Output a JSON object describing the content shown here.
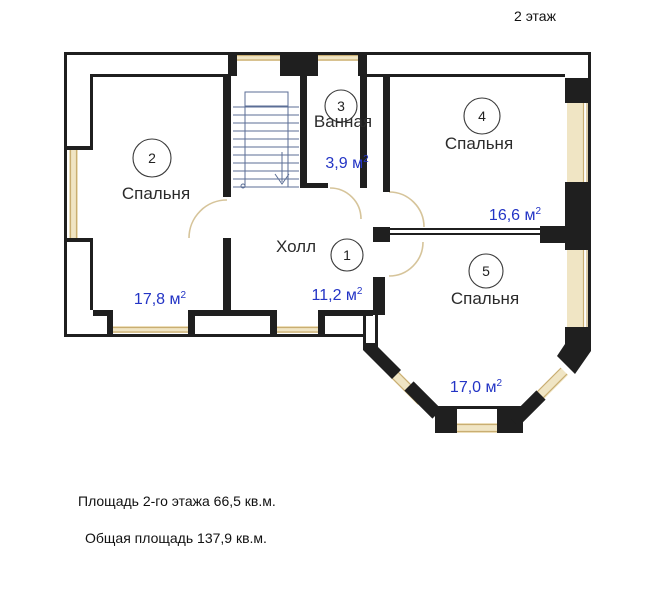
{
  "title": "2 этаж",
  "rooms": [
    {
      "number": "1",
      "name": "Холл",
      "area": "11,2 м",
      "area_sup": "2"
    },
    {
      "number": "2",
      "name": "Спальня",
      "area": "17,8 м",
      "area_sup": "2"
    },
    {
      "number": "3",
      "name": "Ванная",
      "area": "3,9 м",
      "area_sup": "2"
    },
    {
      "number": "4",
      "name": "Спальня",
      "area": "16,6 м",
      "area_sup": "2"
    },
    {
      "number": "5",
      "name": "Спальня",
      "area": "17,0 м",
      "area_sup": "2"
    }
  ],
  "footer": {
    "floor_area": "Площадь 2-го этажа 66,5 кв.м.",
    "total_area": "Общая площадь 137,9 кв.м."
  },
  "colors": {
    "wall": "#1f1f1f",
    "window_fill": "#f0e5c4",
    "window_line": "#c9ae72",
    "door": "#d6c49a",
    "stairs": "#5b6e96",
    "circle": "#3a3a3a",
    "number": "#222222",
    "label": "#2b2b2b",
    "area": "#2334c5",
    "text": "#111111"
  }
}
